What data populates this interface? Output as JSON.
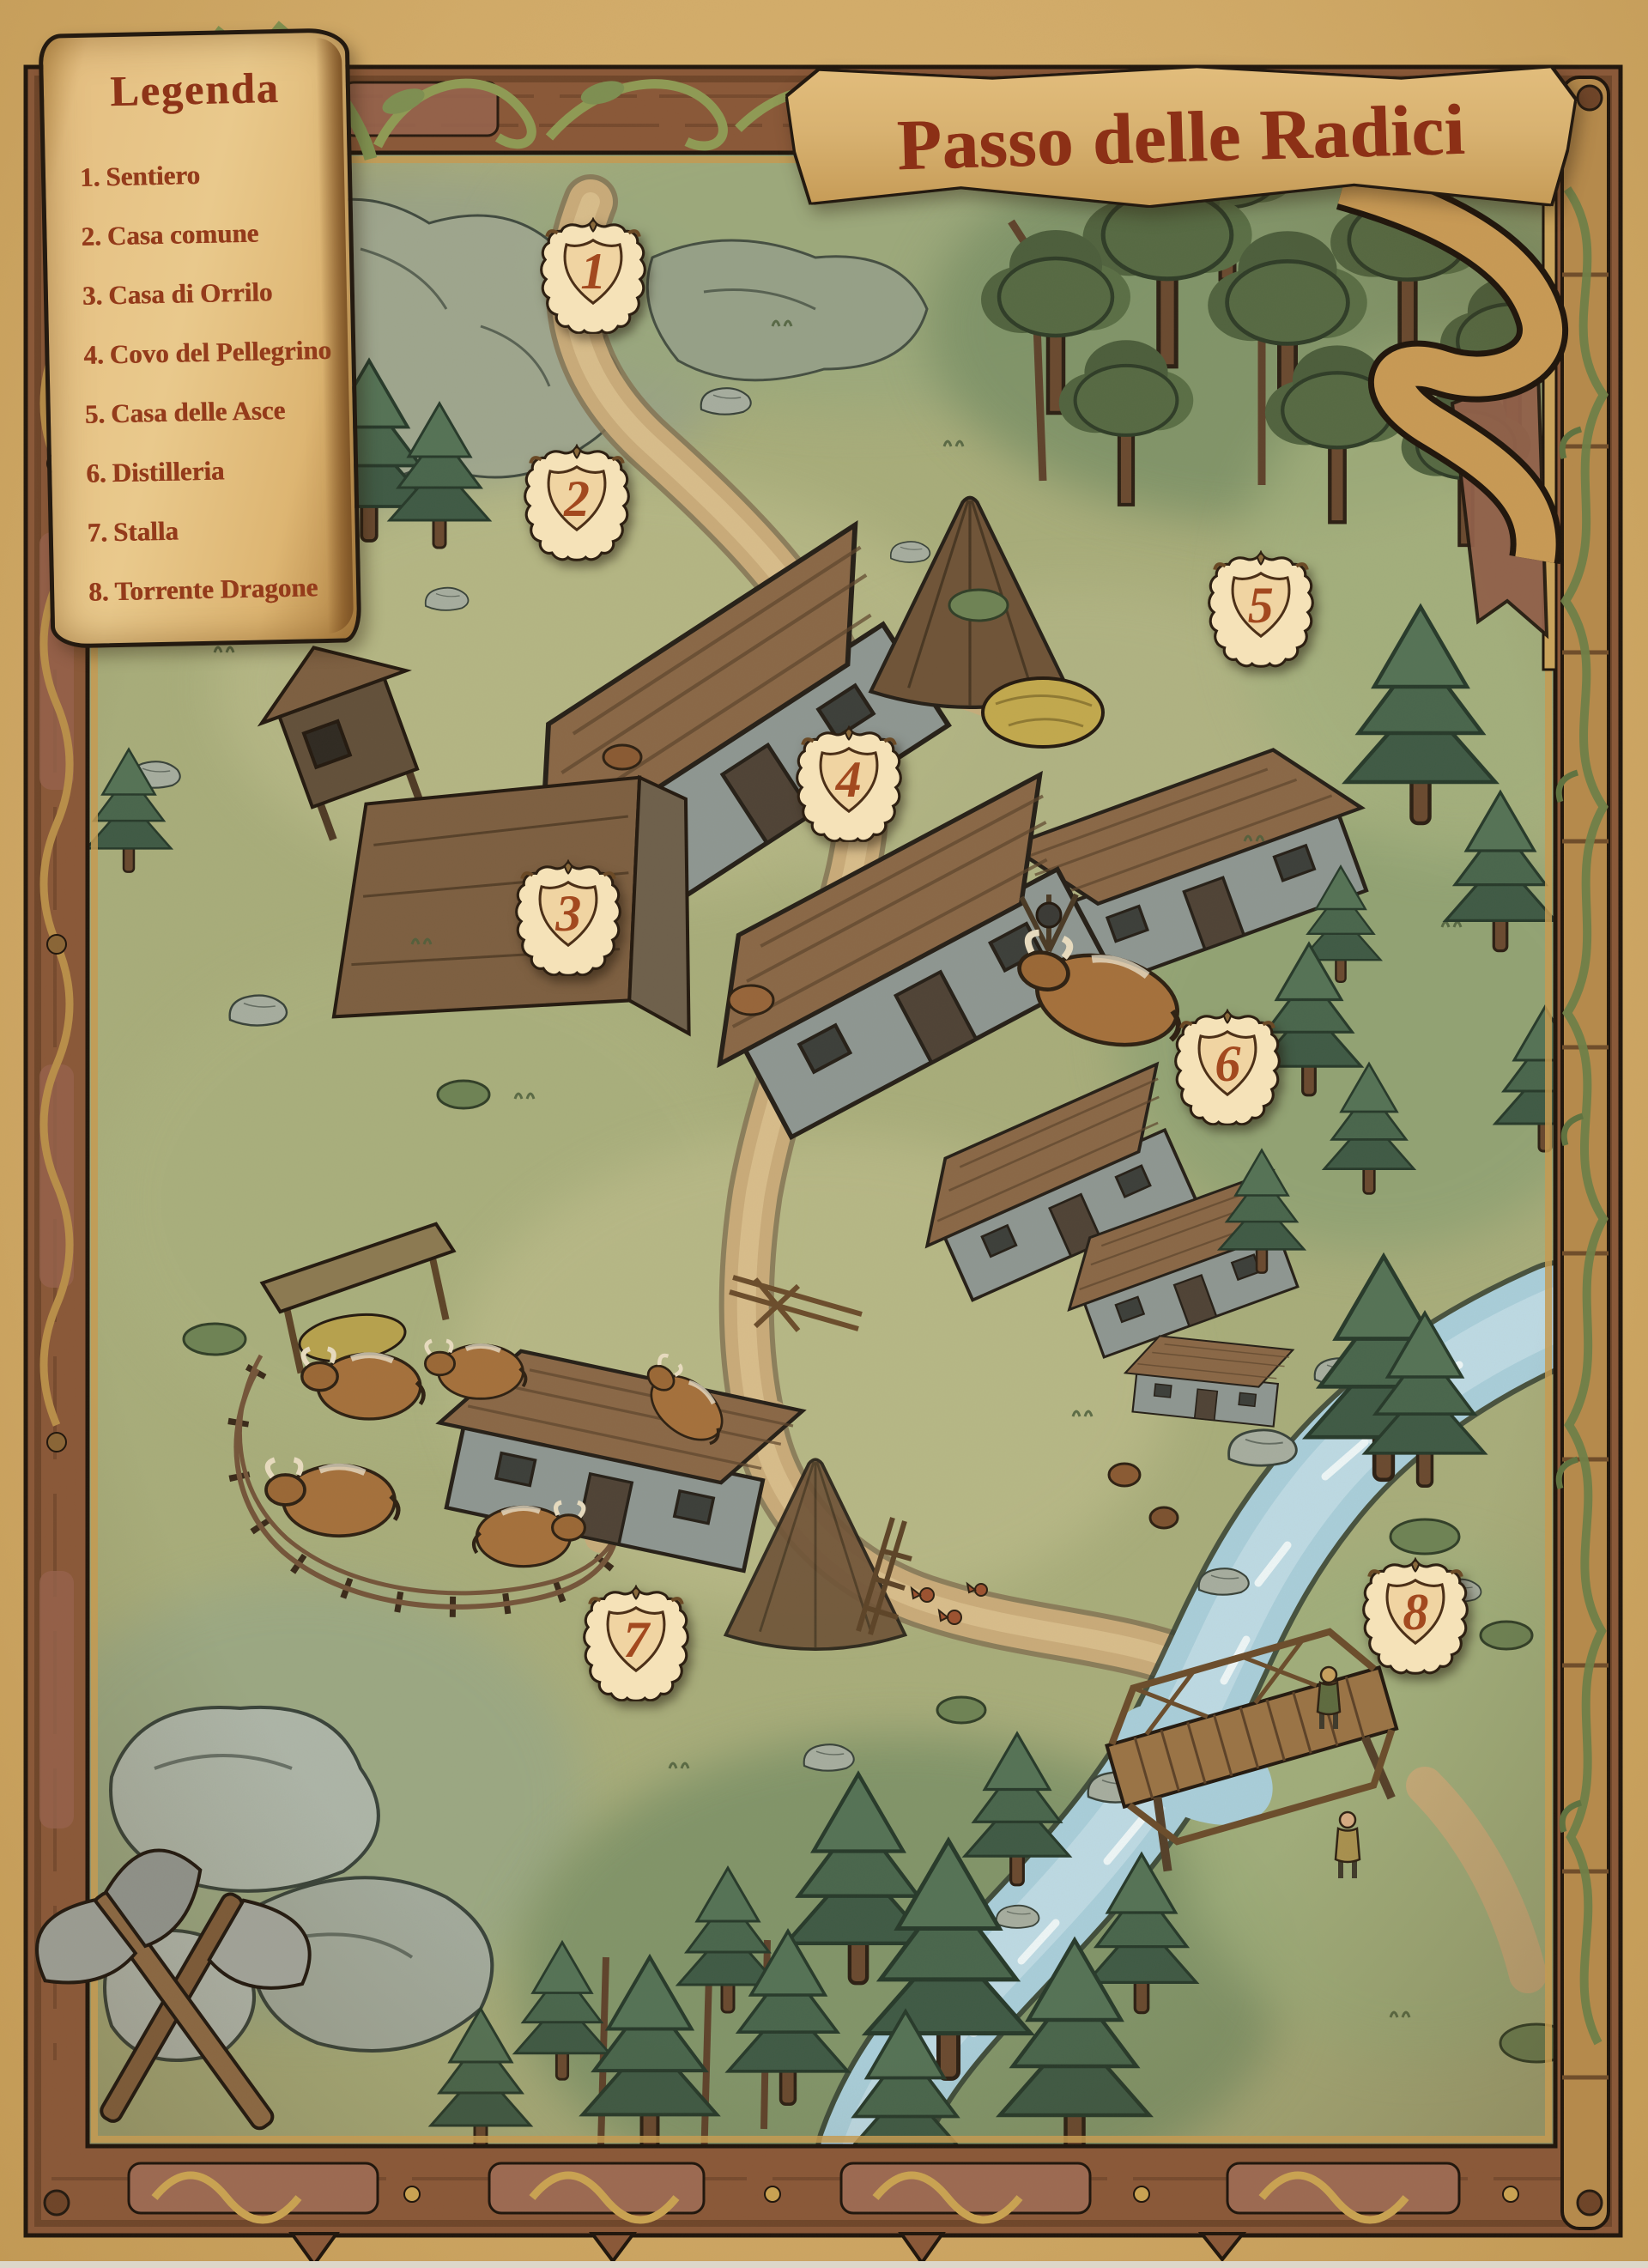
{
  "title_banner": {
    "text": "Passo delle Radici"
  },
  "legend": {
    "title": "Legenda",
    "items": [
      {
        "num": "1.",
        "label": "Sentiero"
      },
      {
        "num": "2.",
        "label": "Casa comune"
      },
      {
        "num": "3.",
        "label": "Casa di Orrilo"
      },
      {
        "num": "4.",
        "label": "Covo del Pellegrino"
      },
      {
        "num": "5.",
        "label": "Casa delle Asce"
      },
      {
        "num": "6.",
        "label": "Distilleria"
      },
      {
        "num": "7.",
        "label": "Stalla"
      },
      {
        "num": "8.",
        "label": "Torrente Dragone"
      }
    ]
  },
  "markers": [
    {
      "num": "1",
      "x_pct": 36.0,
      "y_pct": 12.3
    },
    {
      "num": "2",
      "x_pct": 35.0,
      "y_pct": 22.3
    },
    {
      "num": "3",
      "x_pct": 34.5,
      "y_pct": 40.6
    },
    {
      "num": "4",
      "x_pct": 51.5,
      "y_pct": 34.7
    },
    {
      "num": "5",
      "x_pct": 76.5,
      "y_pct": 27.0
    },
    {
      "num": "6",
      "x_pct": 74.5,
      "y_pct": 47.2
    },
    {
      "num": "7",
      "x_pct": 38.6,
      "y_pct": 72.6
    },
    {
      "num": "8",
      "x_pct": 85.9,
      "y_pct": 71.4
    }
  ],
  "colors": {
    "ink_red": "#8e3418",
    "shield_cream": "#f5e2b8",
    "parchment": "#d6b175",
    "frame_wood": "#8a5838",
    "meadow_green": "#a8ad7b",
    "river_blue": "#a9ceda",
    "path_tan": "#c9ab7a",
    "pine_green": "#46604a"
  }
}
